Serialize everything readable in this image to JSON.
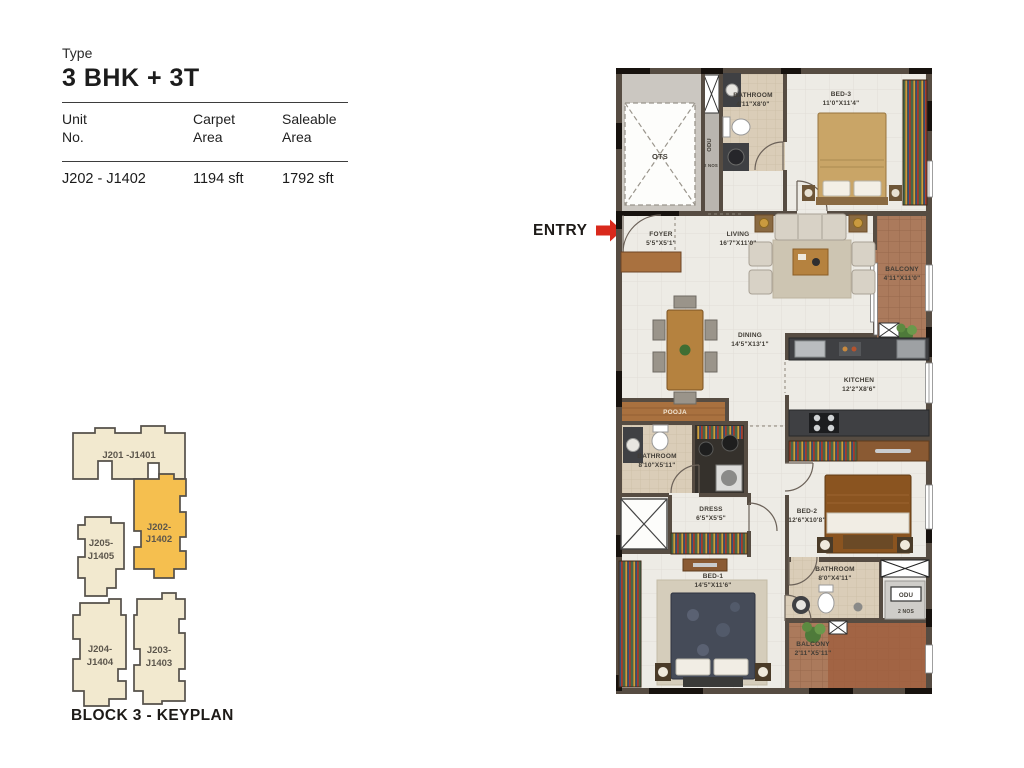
{
  "header": {
    "type_label": "Type",
    "type_value": "3 BHK + 3T",
    "columns": [
      {
        "l1": "Unit",
        "l2": "No."
      },
      {
        "l1": "Carpet",
        "l2": "Area"
      },
      {
        "l1": "Saleable",
        "l2": "Area"
      }
    ],
    "row": {
      "unit": "J202 - J1402",
      "carpet": "1194 sft",
      "saleable": "1792 sft"
    }
  },
  "entry": {
    "label": "ENTRY"
  },
  "plan": {
    "ots": {
      "name": "OTS"
    },
    "odu_top": {
      "name": "ODU",
      "qty": "2 NOS"
    },
    "bathroom_top": {
      "name": "BATHROOM",
      "dims": "4'11\"X8'0\""
    },
    "bed3": {
      "name": "BED-3",
      "dims": "11'0\"X11'4\""
    },
    "foyer": {
      "name": "FOYER",
      "dims": "5'5\"X5'1\""
    },
    "living": {
      "name": "LIVING",
      "dims": "16'7\"X11'0\""
    },
    "balcony_living": {
      "name": "BALCONY",
      "dims": "4'11\"X11'0\""
    },
    "dining": {
      "name": "DINING",
      "dims": "14'5\"X13'1\""
    },
    "kitchen": {
      "name": "KITCHEN",
      "dims": "12'2\"X8'6\""
    },
    "pooja": {
      "name": "POOJA"
    },
    "bathroom_mid": {
      "name": "BATHROOM",
      "dims": "8'10\"X5'11\""
    },
    "dress": {
      "name": "DRESS",
      "dims": "6'5\"X5'5\""
    },
    "bed2": {
      "name": "BED-2",
      "dims": "12'6\"X10'8\""
    },
    "bathroom_bed2": {
      "name": "BATHROOM",
      "dims": "8'0\"X4'11\""
    },
    "odu_bottom": {
      "name": "ODU",
      "qty": "2 NOS"
    },
    "bed1": {
      "name": "BED-1",
      "dims": "14'5\"X11'6\""
    },
    "balcony_bed1": {
      "name": "BALCONY",
      "dims": "2'11\"X5'11\""
    }
  },
  "keyplan": {
    "caption": "BLOCK 3 - KEYPLAN",
    "units": [
      {
        "id": "J201-J1401",
        "lines": [
          "J201 -J1401",
          ""
        ],
        "highlighted": false
      },
      {
        "id": "J202-J1402",
        "lines": [
          "J202-",
          "J1402"
        ],
        "highlighted": true
      },
      {
        "id": "J205-J1405",
        "lines": [
          "J205-",
          "J1405"
        ],
        "highlighted": false
      },
      {
        "id": "J204-J1404",
        "lines": [
          "J204-",
          "J1404"
        ],
        "highlighted": false
      },
      {
        "id": "J203-J1403",
        "lines": [
          "J203-",
          "J1403"
        ],
        "highlighted": false
      }
    ]
  },
  "colors": {
    "accent_red": "#d9291c",
    "keyplan_fill": "#f2e9cf",
    "keyplan_highlight": "#f5bf4f",
    "balcony_floor": "#aa795c",
    "wall": "#5a5047"
  }
}
